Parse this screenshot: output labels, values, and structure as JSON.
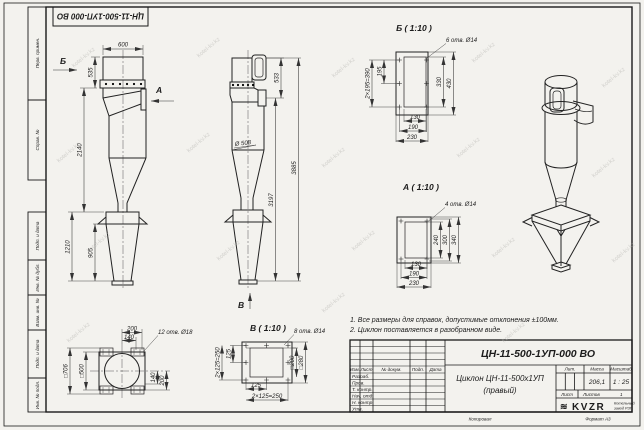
{
  "doc": {
    "top_stamp": "ЦН-11-500-1УП-000 ВО",
    "number": "ЦН-11-500-1УП-000 ВО",
    "name_line1": "Циклон ЦН-11-500х1УП",
    "name_line2": "(правый)"
  },
  "sidebar": {
    "labels": [
      "Перв. примен.",
      "Справ. №",
      "Подп. и дата",
      "Инв. № дубл.",
      "Взам. инв. №",
      "Подп. и дата",
      "Инв. № подл."
    ]
  },
  "views": {
    "front": {
      "dim_top": "600",
      "dim_upper": "535",
      "dim_body": "2140",
      "dim_hopper": "1210",
      "dim_cone": "905",
      "arrow_b": "Б",
      "arrow_a": "А"
    },
    "side": {
      "dim_upper": "533",
      "dim_inner": "3197",
      "dim_total": "3885",
      "dia": "Ø 508",
      "arrow_v": "В"
    },
    "view_b": {
      "title": "Б ( 1:10 )",
      "holes": "6 отв. Ø14",
      "dim_left_half": "195",
      "dim_left_total": "2×195=390",
      "dim_right_inner": "330",
      "dim_right_outer": "430",
      "dim_b1": "130",
      "dim_b2": "190",
      "dim_b3": "230"
    },
    "view_a": {
      "title": "А ( 1:10 )",
      "holes": "4 отв. Ø14",
      "dim_r1": "240",
      "dim_r2": "300",
      "dim_r3": "340",
      "dim_b1": "130",
      "dim_b2": "190",
      "dim_b3": "230"
    },
    "view_v": {
      "title": "В ( 1:10 )",
      "holes": "8 отв. Ø14",
      "dim_left_half": "125",
      "dim_left_total": "2×125=250",
      "dim_sq_inner": "□200",
      "dim_sq_outer": "□280",
      "dim_b1": "125",
      "dim_b2": "2×125=250"
    },
    "top": {
      "holes": "12 отв. Ø18",
      "dim_t1": "200",
      "dim_t2": "140",
      "dim_sq_outer": "□706",
      "dim_sq_inner": "□500",
      "dim_r1": "140",
      "dim_r2": "200"
    }
  },
  "notes": {
    "line1": "1. Все размеры для справок, допустимые отклонения ±100мм.",
    "line2": "2. Циклон поставляется в разобранном виде."
  },
  "title_block": {
    "header_cols": [
      "Изм.",
      "Лист",
      "№ докум.",
      "Подп.",
      "Дата"
    ],
    "rows": [
      "Разраб.",
      "Пров.",
      "Т. контр.",
      "Нач. отд.",
      "Н. контр.",
      "Утв."
    ],
    "lit_label": "Лит.",
    "mass_label": "Масса",
    "scale_label": "Масштаб",
    "mass": "206,1",
    "scale": "1 : 25",
    "sheet_label": "Лист",
    "sheets_label": "Листов",
    "sheets_value": "1",
    "logo": "KVZR",
    "logo_mark": "≋",
    "company_line1": "Котельный",
    "company_line2": "завод РЗП",
    "footer_copy": "Копировал",
    "footer_format": "Формат А3"
  },
  "watermark": {
    "text": "kotel-kv.kz"
  }
}
